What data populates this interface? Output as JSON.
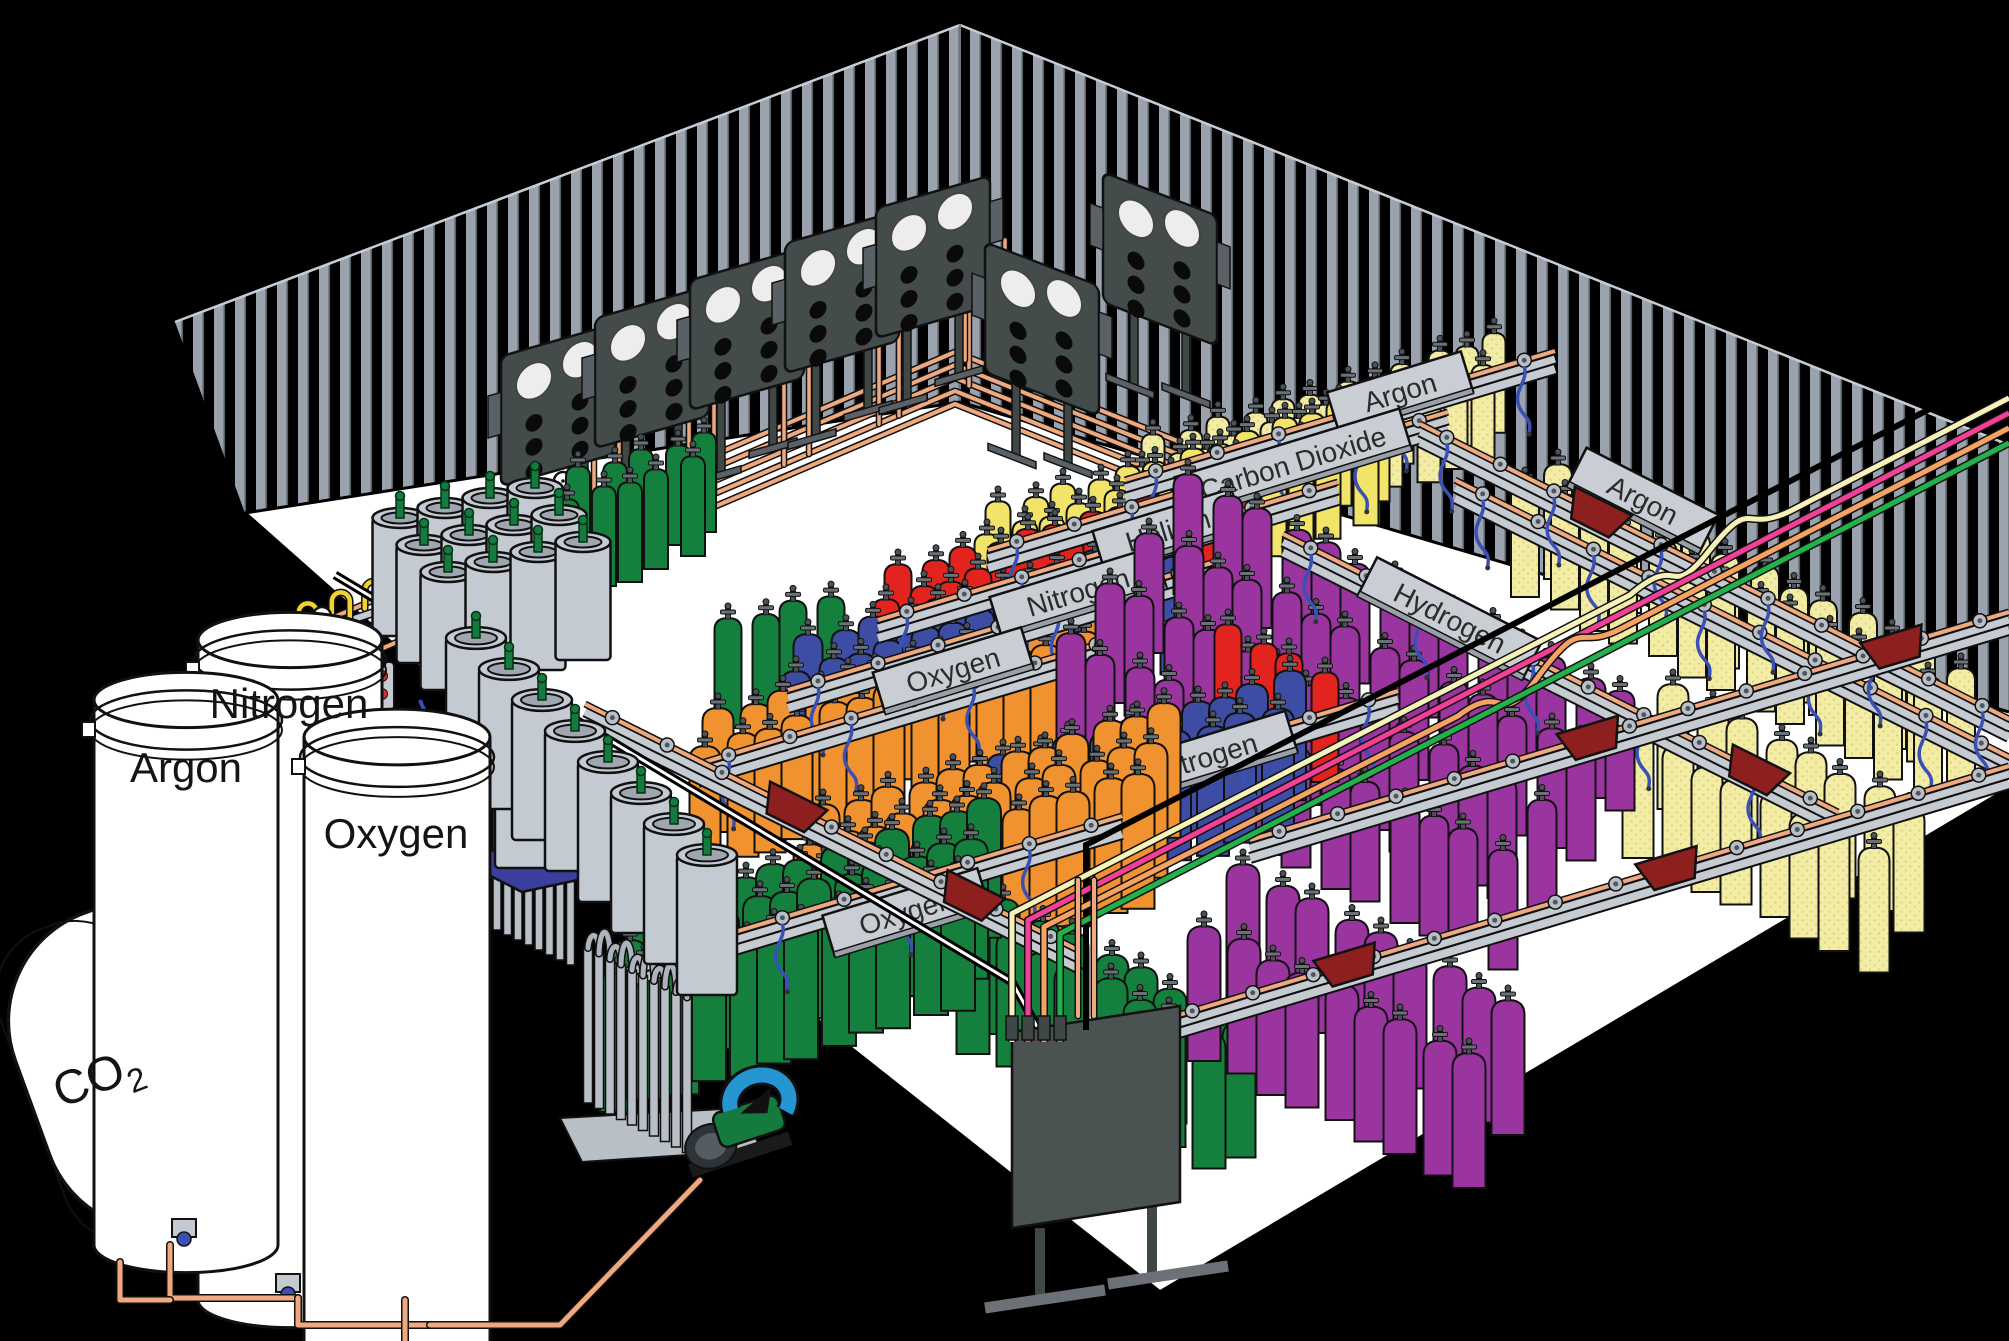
{
  "diagram": {
    "type": "isometric-illustration",
    "subject": "Industrial gas cylinder filling plant",
    "storage_tanks": {
      "co2": {
        "label_main": "CO",
        "label_sub": "2"
      },
      "argon": {
        "label": "Argon"
      },
      "nitrogen": {
        "label": "Nitrogen"
      },
      "oxygen": {
        "label": "Oxygen"
      }
    },
    "rack_signs": [
      {
        "label": "Argon",
        "x": 1400,
        "y": 392,
        "rot": -17,
        "w": 140
      },
      {
        "label": "Carbon Dioxide",
        "x": 1293,
        "y": 463,
        "rot": -17,
        "w": 235
      },
      {
        "label": "Helium",
        "x": 1168,
        "y": 530,
        "rot": -17,
        "w": 145
      },
      {
        "label": "Nitrogen",
        "x": 1078,
        "y": 592,
        "rot": -17,
        "w": 172
      },
      {
        "label": "Oxygen",
        "x": 953,
        "y": 670,
        "rot": -17,
        "w": 155
      },
      {
        "label": "Argon",
        "x": 1643,
        "y": 500,
        "rot": 27,
        "w": 148
      },
      {
        "label": "Hydrogen",
        "x": 1450,
        "y": 618,
        "rot": 27,
        "w": 185
      },
      {
        "label": "Nitrogen",
        "x": 1206,
        "y": 757,
        "rot": -17,
        "w": 178
      },
      {
        "label": "Oxygen",
        "x": 906,
        "y": 912,
        "rot": -17,
        "w": 162
      }
    ],
    "gas_colors": {
      "oxygen_green": "#15803D",
      "oxygen_orange": "#F19231",
      "nitrogen_blue": "#3D4DA4",
      "helium_red": "#E3231D",
      "carbon_dioxide_yellow": "#F2E468",
      "argon_pale_yellow": "#F2ECA4",
      "hydrogen_purple": "#9A35A0"
    },
    "pipe_colors": {
      "copper": "#EFA97E",
      "hose_blue": "#3A50B4",
      "tube_cream": "#F7F2B8",
      "tube_pink": "#F23F97",
      "tube_salmon": "#F5A263",
      "tube_green": "#22B14C",
      "pigtail_yellow": "#F2D22E"
    },
    "structure_colors": {
      "background": "#000000",
      "floor": "#FFFFFF",
      "wall_stud": "#9AA2AE",
      "rail_gray": "#C6CBD2",
      "sign_gray": "#C9CED4",
      "manifold_panel": "#434B4B",
      "cart_red": "#8E1F1F",
      "dewar_gray": "#C4CAD2",
      "valve_green": "#157A3D",
      "scale_blue": "#3A3F9E",
      "pump_blue": "#2596D2",
      "button_red": "#D43030",
      "outline": "#111111"
    },
    "layout": {
      "walls": {
        "left": "175,322 960,25 960,402 245,513",
        "right": "960,25 2009,445 2009,712 960,402",
        "left_top": [
          175,
          322,
          960,
          25
        ],
        "right_top": [
          960,
          25,
          2009,
          445
        ]
      },
      "floor": {
        "poly": "245,513 960,402 2009,712 2009,788 1160,1292 838,1038",
        "edges": [
          "M245,513 L838,1038 L1160,1292",
          "M2009,788 L1160,1292"
        ]
      },
      "wall_bundle": {
        "n": 5,
        "gap": 13,
        "pts": [
          [
            140,
            872
          ],
          [
            245,
            655
          ],
          [
            955,
            352
          ],
          [
            1230,
            462
          ]
        ]
      },
      "risers_x": [
        560,
        655,
        750,
        845,
        935
      ],
      "manifold_panels": [
        {
          "x": 558,
          "y": 438,
          "skew": -16
        },
        {
          "x": 652,
          "y": 400,
          "skew": -16
        },
        {
          "x": 747,
          "y": 362,
          "skew": -16
        },
        {
          "x": 842,
          "y": 325,
          "skew": -16
        },
        {
          "x": 933,
          "y": 290,
          "skew": -16
        },
        {
          "x": 1042,
          "y": 362,
          "skew": 21
        },
        {
          "x": 1160,
          "y": 292,
          "skew": 21
        }
      ],
      "cylinder_groups": [
        {
          "gas": "argon",
          "color": "pale",
          "start": [
            1158,
            438
          ],
          "n": 12,
          "rows": 2,
          "step": [
            31,
            -9.3
          ],
          "row_off": [
            -13,
            25
          ],
          "w": 23,
          "h": 100
        },
        {
          "gas": "carbon-dioxide",
          "color": "#F2E468",
          "start": [
            1003,
            505
          ],
          "n": 13,
          "rows": 2,
          "step": [
            31,
            -9.3
          ],
          "row_off": [
            -13,
            26
          ],
          "w": 25,
          "h": 106
        },
        {
          "gas": "oxygen-back",
          "color": "#15803D",
          "start": [
            583,
            470
          ],
          "n": 5,
          "rows": 2,
          "step": [
            30,
            -9
          ],
          "row_off": [
            -13,
            26
          ],
          "w": 24,
          "h": 100
        },
        {
          "gas": "helium",
          "color": "#E3231D",
          "start": [
            903,
            568
          ],
          "n": 12,
          "rows": 2,
          "step": [
            31,
            -9.3
          ],
          "row_off": [
            -14,
            28
          ],
          "w": 27,
          "h": 112
        },
        {
          "gas": "oxygen-mid",
          "color": "#15803D",
          "start": [
            733,
            622
          ],
          "n": 4,
          "rows": 1,
          "step": [
            31,
            -9.3
          ],
          "row_off": [
            0,
            0
          ],
          "w": 27,
          "h": 110
        },
        {
          "gas": "nitrogen",
          "color": "#3D4DA4",
          "start": [
            813,
            638
          ],
          "n": 13,
          "rows": 2,
          "step": [
            31,
            -9.3
          ],
          "row_off": [
            -14,
            30
          ],
          "w": 29,
          "h": 118
        },
        {
          "gas": "oxygen-orange",
          "color": "#F19231",
          "start": [
            723,
            712
          ],
          "n": 13,
          "rows": 2,
          "step": [
            31,
            -9.3
          ],
          "row_off": [
            -15,
            31
          ],
          "w": 31,
          "h": 124
        },
        {
          "gas": "argon-right",
          "color": "pale",
          "start": [
            1563,
            468
          ],
          "n": 13,
          "rows": 2,
          "step": [
            33,
            16.5
          ],
          "row_off": [
            -35,
            11
          ],
          "w": 28,
          "h": 115
        },
        {
          "gas": "argon-right-2",
          "color": "pale",
          "start": [
            1678,
            688
          ],
          "n": 8,
          "rows": 2,
          "step": [
            33,
            16.5
          ],
          "row_off": [
            -37,
            42
          ],
          "w": 31,
          "h": 125
        },
        {
          "gas": "hydrogen",
          "color": "#9A35A0",
          "start": [
            1193,
            478
          ],
          "n": 14,
          "rows": 4,
          "step": [
            33,
            16.5
          ],
          "row_off": [
            -41,
            52
          ],
          "w": 29,
          "h": 120
        },
        {
          "gas": "helium-center",
          "color": "#E3231D",
          "start": [
            1233,
            628
          ],
          "n": 4,
          "rows": 1,
          "step": [
            29,
            14
          ],
          "row_off": [
            0,
            0
          ],
          "w": 27,
          "h": 110
        },
        {
          "gas": "nitrogen-front",
          "color": "#3D4DA4",
          "start": [
            1008,
            758
          ],
          "n": 10,
          "rows": 2,
          "step": [
            31,
            -9.3
          ],
          "row_off": [
            -14,
            31
          ],
          "w": 32,
          "h": 130
        },
        {
          "gas": "orange-central",
          "color": "#F19231",
          "start": [
            828,
            808
          ],
          "n": 12,
          "rows": 3,
          "step": [
            31,
            -9.3
          ],
          "row_off": [
            -15,
            33
          ],
          "w": 33,
          "h": 135
        },
        {
          "gas": "oxygen-side",
          "color": "#15803D",
          "start": [
            1008,
            903
          ],
          "n": 8,
          "rows": 2,
          "step": [
            33,
            16.5
          ],
          "row_off": [
            -32,
            13
          ],
          "w": 33,
          "h": 135
        },
        {
          "gas": "hydrogen-front",
          "color": "#9A35A0",
          "start": [
            1248,
            868
          ],
          "n": 9,
          "rows": 2,
          "step": [
            33,
            16.5
          ],
          "row_off": [
            -41,
            55
          ],
          "w": 33,
          "h": 135
        },
        {
          "gas": "oxygen-front",
          "color": "#15803D",
          "start": [
            648,
            903
          ],
          "n": 12,
          "rows": 3,
          "step": [
            31,
            -9.3
          ],
          "row_off": [
            -15,
            34
          ],
          "w": 34,
          "h": 140
        }
      ],
      "racks": [
        {
          "x1": 1125,
          "y1": 488,
          "x2": 1555,
          "y2": 359,
          "sign": 0,
          "carts": [
            0.68
          ]
        },
        {
          "x1": 988,
          "y1": 558,
          "x2": 1448,
          "y2": 420,
          "sign": 1,
          "carts": []
        },
        {
          "x1": 878,
          "y1": 628,
          "x2": 1338,
          "y2": 490,
          "sign": 2,
          "carts": []
        },
        {
          "x1": 788,
          "y1": 698,
          "x2": 1268,
          "y2": 554,
          "sign": 3,
          "carts": []
        },
        {
          "x1": 698,
          "y1": 772,
          "x2": 1188,
          "y2": 625,
          "sign": 4,
          "carts": []
        },
        {
          "x1": 1455,
          "y1": 488,
          "x2": 2009,
          "y2": 765,
          "sign": 5,
          "carts": []
        },
        {
          "x1": 1283,
          "y1": 542,
          "x2": 1838,
          "y2": 820,
          "sign": 6,
          "carts": [
            0.85
          ]
        },
        {
          "x1": 985,
          "y1": 823,
          "x2": 1398,
          "y2": 699,
          "sign": 7,
          "carts": []
        },
        {
          "x1": 628,
          "y1": 972,
          "x2": 1122,
          "y2": 824,
          "sign": 8,
          "carts": []
        },
        {
          "x1": 1420,
          "y1": 432,
          "x2": 2009,
          "y2": 727,
          "sign": null,
          "carts": [
            0.3
          ]
        }
      ],
      "cart_rails": [
        {
          "x1": 585,
          "y1": 712,
          "x2": 1078,
          "y2": 958,
          "carts": [
            0.42,
            0.78
          ]
        },
        {
          "x1": 1162,
          "y1": 1028,
          "x2": 2009,
          "y2": 774,
          "carts": [
            0.22,
            0.6
          ]
        },
        {
          "x1": 1250,
          "y1": 848,
          "x2": 2009,
          "y2": 620,
          "carts": [
            0.45,
            0.85
          ]
        }
      ],
      "supply_tubes": {
        "x_right": 2009,
        "y0": 398,
        "dy": 15,
        "slope": 0.517,
        "vx0": 1012,
        "vdx": 16,
        "land_y": 1042
      },
      "black_pipes": [
        "M2009,368 L1086,845 L1086,1030"
      ],
      "floor_pipes": [
        "M335,575 L1012,982 L1040,1032"
      ],
      "distribution_panel": {
        "pts": "1012,1032 1180,1006 1180,1202 1012,1228",
        "legs": [
          [
            1040,
            1228,
            1040,
            1302
          ],
          [
            1152,
            1204,
            1152,
            1278
          ]
        ],
        "feet": [
          [
            985,
            1308,
            1105,
            1290
          ],
          [
            1108,
            1284,
            1228,
            1266
          ]
        ]
      },
      "dewars": {
        "cluster": {
          "start": [
            400,
            518
          ],
          "n": 4,
          "rows": 3,
          "step": [
            45,
            -10
          ],
          "row_off": [
            24,
            27
          ],
          "w": 55,
          "h": 118
        },
        "lane": {
          "start": [
            476,
            638
          ],
          "n": 8,
          "step": [
            33,
            31
          ],
          "w": 60,
          "h": 140
        },
        "scale_dewar": {
          "x": 524,
          "y": 736,
          "w": 58,
          "h": 132
        },
        "scale_pts": "455,858 585,832 652,864 522,892"
      },
      "vaporizer": {
        "bank1": {
          "x": 455,
          "y": 742,
          "n": 12,
          "step": [
            10.5,
            5
          ],
          "h": 168,
          "w": 8
        },
        "bank2": {
          "x": 588,
          "y": 948,
          "n": 10,
          "step": [
            11,
            5.5
          ],
          "h": 155,
          "w": 9
        },
        "pad": "560,1118 740,1108 762,1150 582,1162"
      },
      "tanks": {
        "argon": {
          "cx": 186,
          "r": 92,
          "top": 700,
          "bot": 1245
        },
        "nitrogen": {
          "cx": 290,
          "r": 92,
          "top": 640,
          "bot": 1300
        },
        "oxygen": {
          "cx": 397,
          "r": 93,
          "top": 737,
          "bot": 1341
        },
        "co2": {
          "cx": 218,
          "cy": 1040,
          "rot": -20,
          "w": 395,
          "h": 330,
          "rx": 115
        }
      },
      "tank_pipes": [
        "M170,1245 L170,1298 L298,1298",
        "M298,1298 L298,1325 L430,1325",
        "M120,1262 L120,1300 L170,1300",
        "M430,1325 L560,1325 L700,1180",
        "M405,1300 L405,1341"
      ],
      "pump": {
        "x": 735,
        "y": 1130,
        "rot": -18
      },
      "stations": {
        "barA": [
          255,
          652,
          420,
          597
        ],
        "gauges": [
          [
            322,
            624
          ],
          [
            382,
            598
          ],
          [
            563,
            489
          ]
        ],
        "control_box": {
          "x": 352,
          "y": 662
        },
        "outside_pigtails": [
          [
            285,
            775
          ],
          [
            312,
            763
          ],
          [
            340,
            751
          ]
        ],
        "dewar_hose": "M420,700 C430,730 450,725 462,745"
      }
    }
  }
}
